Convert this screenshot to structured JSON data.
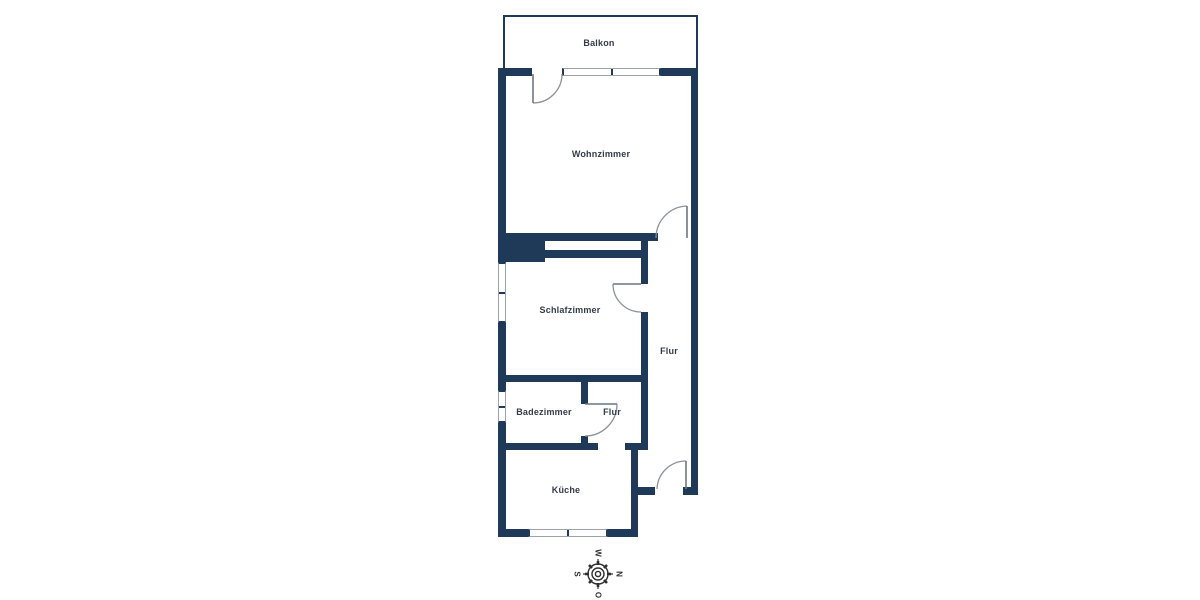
{
  "rooms": {
    "balkon": {
      "label": "Balkon"
    },
    "wohnzimmer": {
      "label": "Wohnzimmer"
    },
    "schlafzimmer": {
      "label": "Schlafzimmer"
    },
    "flur": {
      "label": "Flur"
    },
    "badezimmer": {
      "label": "Badezimmer"
    },
    "flur_klein": {
      "label": "Flur"
    },
    "kueche": {
      "label": "Küche"
    }
  },
  "compass": {
    "north": "N",
    "east": "O",
    "south": "S",
    "west": "W"
  },
  "colors": {
    "wall": "#1f3a58",
    "room_label": "#333b49",
    "door_arc": "#8b929c",
    "compass": "#2f2f2f",
    "background": "#ffffff"
  }
}
